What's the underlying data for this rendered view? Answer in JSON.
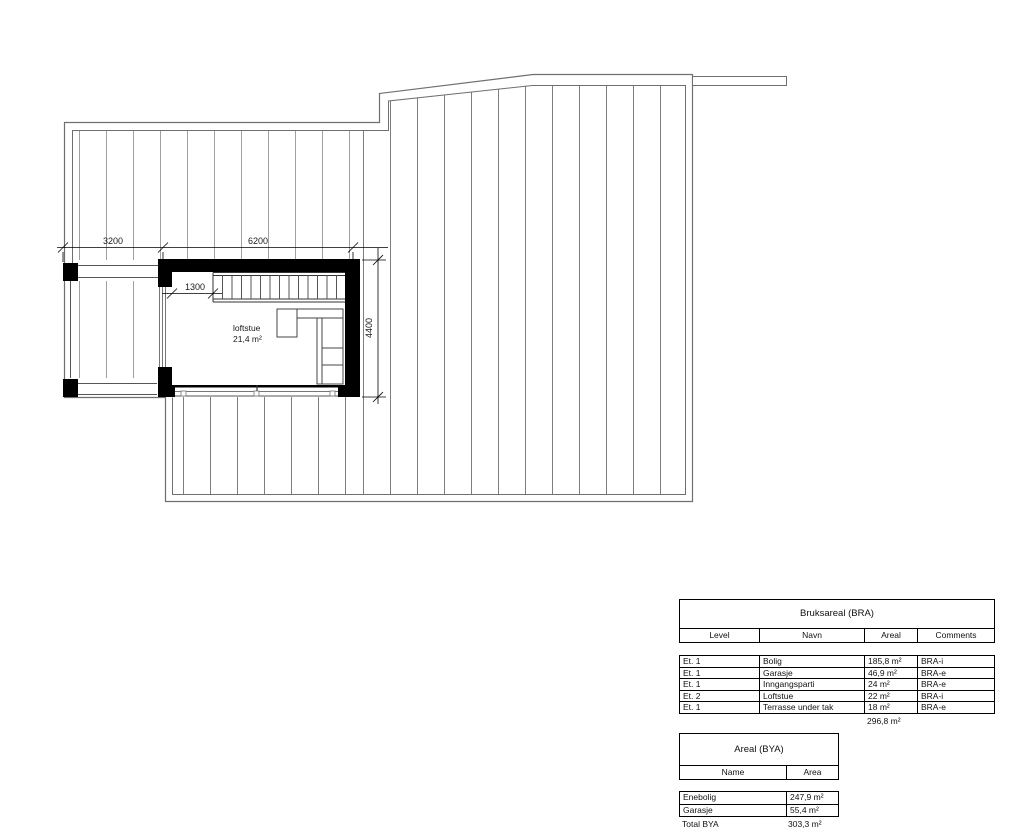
{
  "plan": {
    "room": {
      "name": "loftstue",
      "area": "21,4 m²"
    },
    "dims": {
      "left": "3200",
      "top": "6200",
      "stair": "1300",
      "right": "4400"
    }
  },
  "bra_table": {
    "title": "Bruksareal (BRA)",
    "columns": [
      "Level",
      "Navn",
      "Areal",
      "Comments"
    ],
    "rows": [
      {
        "level": "Et. 1",
        "navn": "Bolig",
        "areal": "185,8 m²",
        "comments": "BRA-i"
      },
      {
        "level": "Et. 1",
        "navn": "Garasje",
        "areal": "46,9 m²",
        "comments": "BRA-e"
      },
      {
        "level": "Et. 1",
        "navn": "Inngangsparti",
        "areal": "24 m²",
        "comments": "BRA-e"
      },
      {
        "level": "Et. 2",
        "navn": "Loftstue",
        "areal": "22 m²",
        "comments": "BRA-i"
      },
      {
        "level": "Et. 1",
        "navn": "Terrasse under tak",
        "areal": "18 m²",
        "comments": "BRA-e"
      }
    ],
    "total": "296,8 m²"
  },
  "bya_table": {
    "title": "Areal (BYA)",
    "columns": [
      "Name",
      "Area"
    ],
    "rows": [
      {
        "name": "Enebolig",
        "area": "247,9 m²"
      },
      {
        "name": "Garasje",
        "area": "55,4 m²"
      }
    ],
    "total_label": "Total BYA",
    "total_value": "303,3 m²"
  },
  "colors": {
    "wall": "#000000",
    "outline": "#6f6f6f",
    "hatch_light": "#a0a0a0",
    "hatch_dark": "#7d7d7d"
  }
}
